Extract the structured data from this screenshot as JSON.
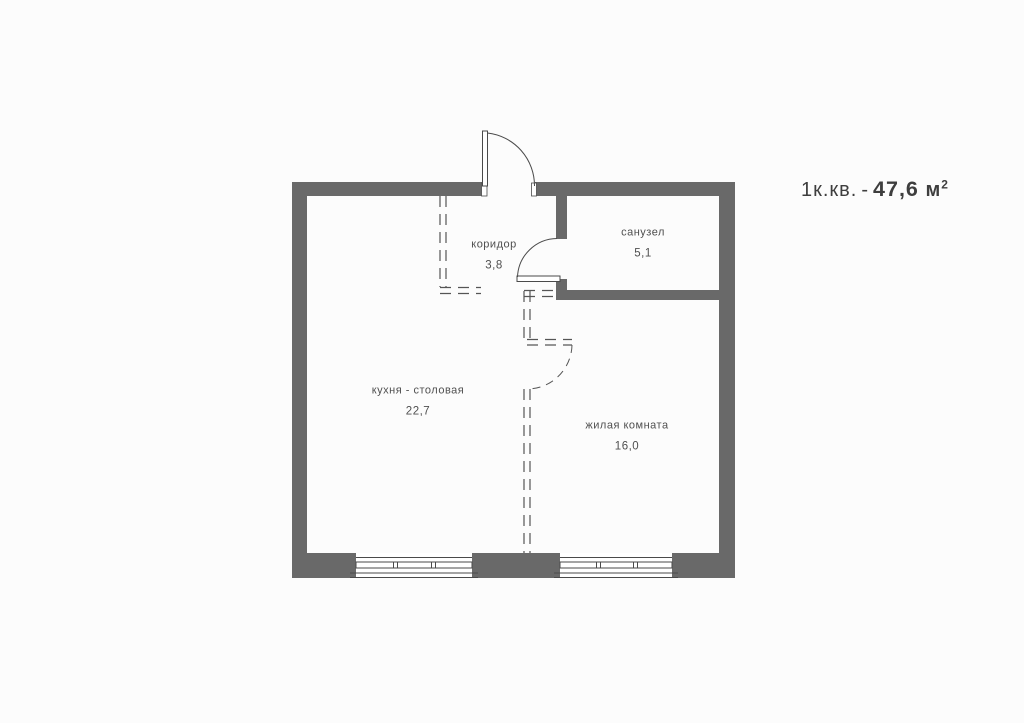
{
  "title": {
    "apartment_type": "1к.кв.",
    "separator": "-",
    "area_value": "47,6",
    "area_unit": "м",
    "area_superscript": "2"
  },
  "rooms": [
    {
      "name": "коридор",
      "area": "3,8"
    },
    {
      "name": "санузел",
      "area": "5,1"
    },
    {
      "name": "кухня - столовая",
      "area": "22,7"
    },
    {
      "name": "жилая комната",
      "area": "16,0"
    }
  ],
  "colors": {
    "wall": "#696969",
    "background": "#fcfcfc",
    "line": "#4a4a4a",
    "dash": "#555555",
    "label-text": "#4f4f4f",
    "title-text": "#3e3e3e"
  }
}
